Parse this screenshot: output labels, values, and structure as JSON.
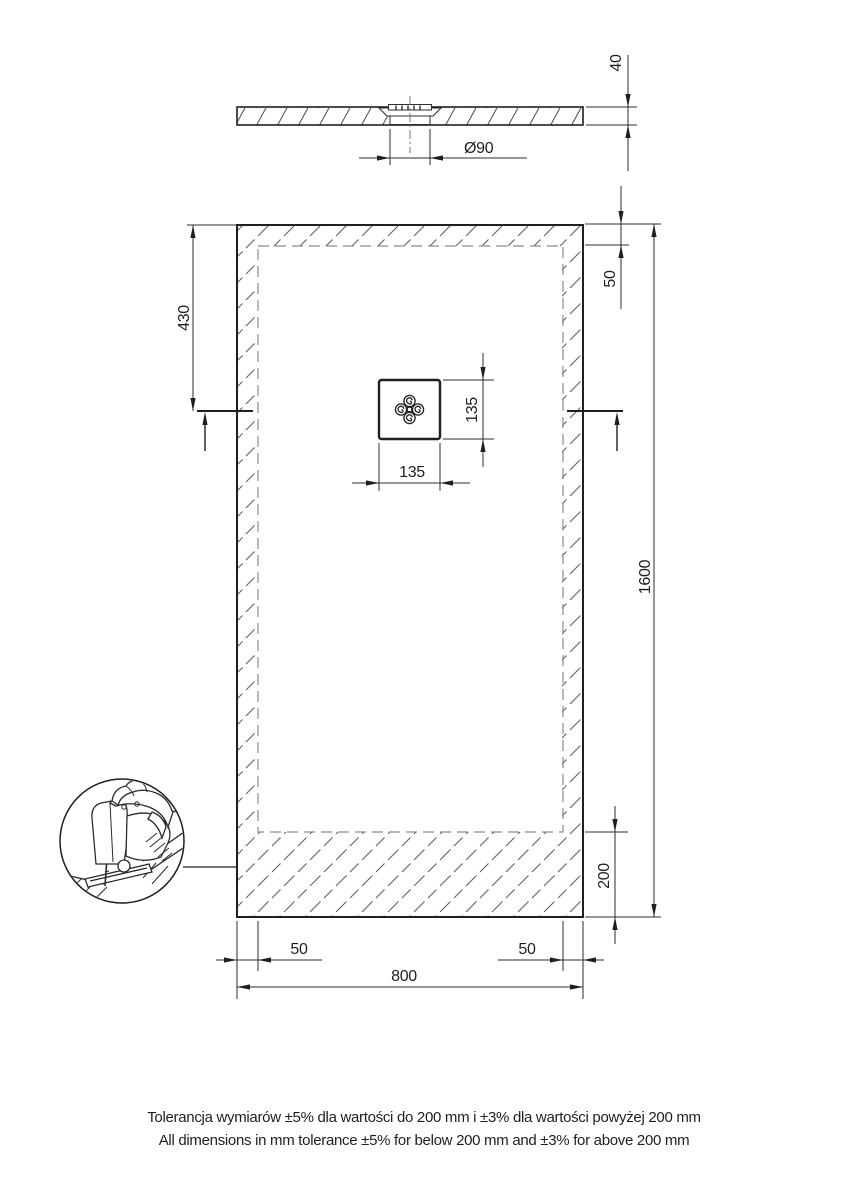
{
  "meta": {
    "title": "Shower tray technical drawing"
  },
  "style": {
    "line_color": "#1f1f1f",
    "thin_line_color": "#2e2e2e",
    "hatch_color": "#555555",
    "dashed_color": "#8c8c8c",
    "background": "#ffffff"
  },
  "profile_view": {
    "thickness_label": "40",
    "drain_diameter_label": "Ø90"
  },
  "plan_view": {
    "offset_top_label": "430",
    "border_top_label": "50",
    "length_label": "1600",
    "drain_height_label": "135",
    "drain_width_label": "135",
    "border_bottom_label": "200",
    "border_left_label": "50",
    "border_right_label": "50",
    "width_label": "800"
  },
  "icons": {
    "jigsaw_detail": "jigsaw-cutting-detail",
    "drain_ornament": "decorative-drain-cover"
  },
  "notes": {
    "tolerance_pl": "Tolerancja wymiarów ±5% dla wartości do 200 mm i ±3% dla wartości powyżej 200 mm",
    "tolerance_en": "All dimensions in mm tolerance ±5% for below 200 mm and ±3% for above 200 mm"
  }
}
